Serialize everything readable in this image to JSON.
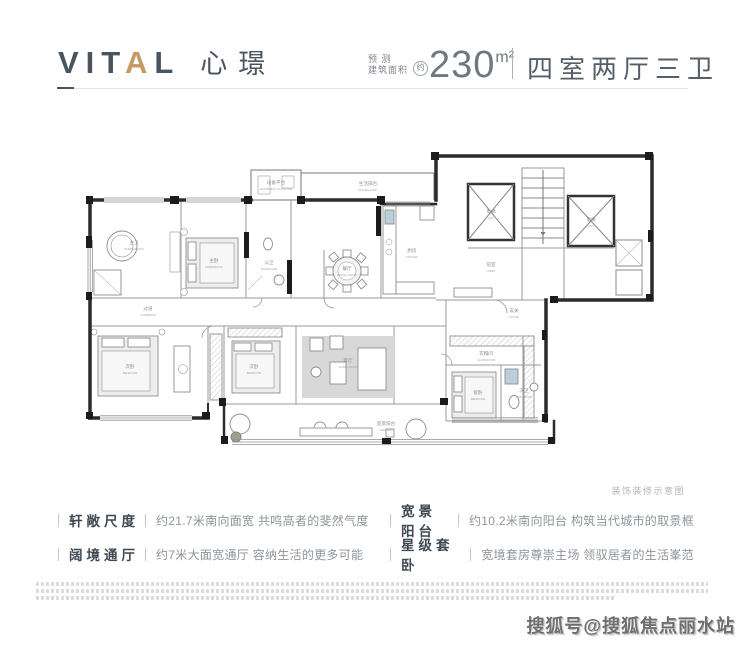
{
  "header": {
    "logo": {
      "part1": "VIT",
      "accent": "A",
      "part2": "L",
      "cn": "心璟"
    },
    "area": {
      "small_line1": "预 测",
      "small_line2": "建筑面积",
      "approx": "约",
      "value": "230",
      "unit": "m²"
    },
    "layout": "四室两厅三卫"
  },
  "plan": {
    "caption": "装饰装修示意图",
    "rooms": {
      "master_bath": {
        "cn": "主卫",
        "en": "M.BATHROOM"
      },
      "master_bed_up": {
        "cn": "主卧",
        "en": "M.BEDROOM"
      },
      "bath_public": {
        "cn": "公卫",
        "en": "BATHROOM"
      },
      "equipment": {
        "cn": "设备平台",
        "en": "EQUIPMENT PLATFORM"
      },
      "life_balcony": {
        "cn": "生活阳台",
        "en": "LIFE BALCONY"
      },
      "dining": {
        "cn": "餐厅",
        "en": "DINING ROOM"
      },
      "kitchen": {
        "cn": "厨房",
        "en": "KITCHEN"
      },
      "lift": {
        "cn": "电梯",
        "en": "LIFT"
      },
      "lobby": {
        "cn": "前室",
        "en": "LOBBY"
      },
      "foyer": {
        "cn": "玄关",
        "en": "FOYER"
      },
      "corridor": {
        "cn": "过道",
        "en": "CORRIDOR"
      },
      "bedroom2": {
        "cn": "次卧",
        "en": "BEDROOM"
      },
      "bedroom3": {
        "cn": "次卧",
        "en": "BEDROOM"
      },
      "living": {
        "cn": "客厅",
        "en": "LIVING ROOM"
      },
      "veranda": {
        "cn": "宽景阳台",
        "en": "VERANDA"
      },
      "cloakroom": {
        "cn": "衣帽间",
        "en": "CLOAKROOM"
      },
      "suite_bed": {
        "cn": "套卧",
        "en": "BEDROOM"
      },
      "suite_bath": {
        "cn": "次卫",
        "en": "BATHROOM"
      }
    }
  },
  "features": [
    {
      "term": "轩敞尺度",
      "desc": "约21.7米南向面宽 共鸣高者的斐然气度"
    },
    {
      "term": "阔境通厅",
      "desc": "约7米大面宽通厅 容纳生活的更多可能"
    },
    {
      "term": "宽景阳台",
      "desc": "约10.2米南向阳台 构筑当代城市的取景框"
    },
    {
      "term": "星级套卧",
      "desc": "宽境套房尊崇主场 领驭居者的生活峯范"
    }
  ],
  "watermark": "搜狐号@搜狐焦点丽水站",
  "colors": {
    "accent_gold": "#c49a62",
    "ink": "#4a545e",
    "text_gray": "#8d949b",
    "wall": "#222222",
    "fixture_blue": "#b9cfdd"
  }
}
